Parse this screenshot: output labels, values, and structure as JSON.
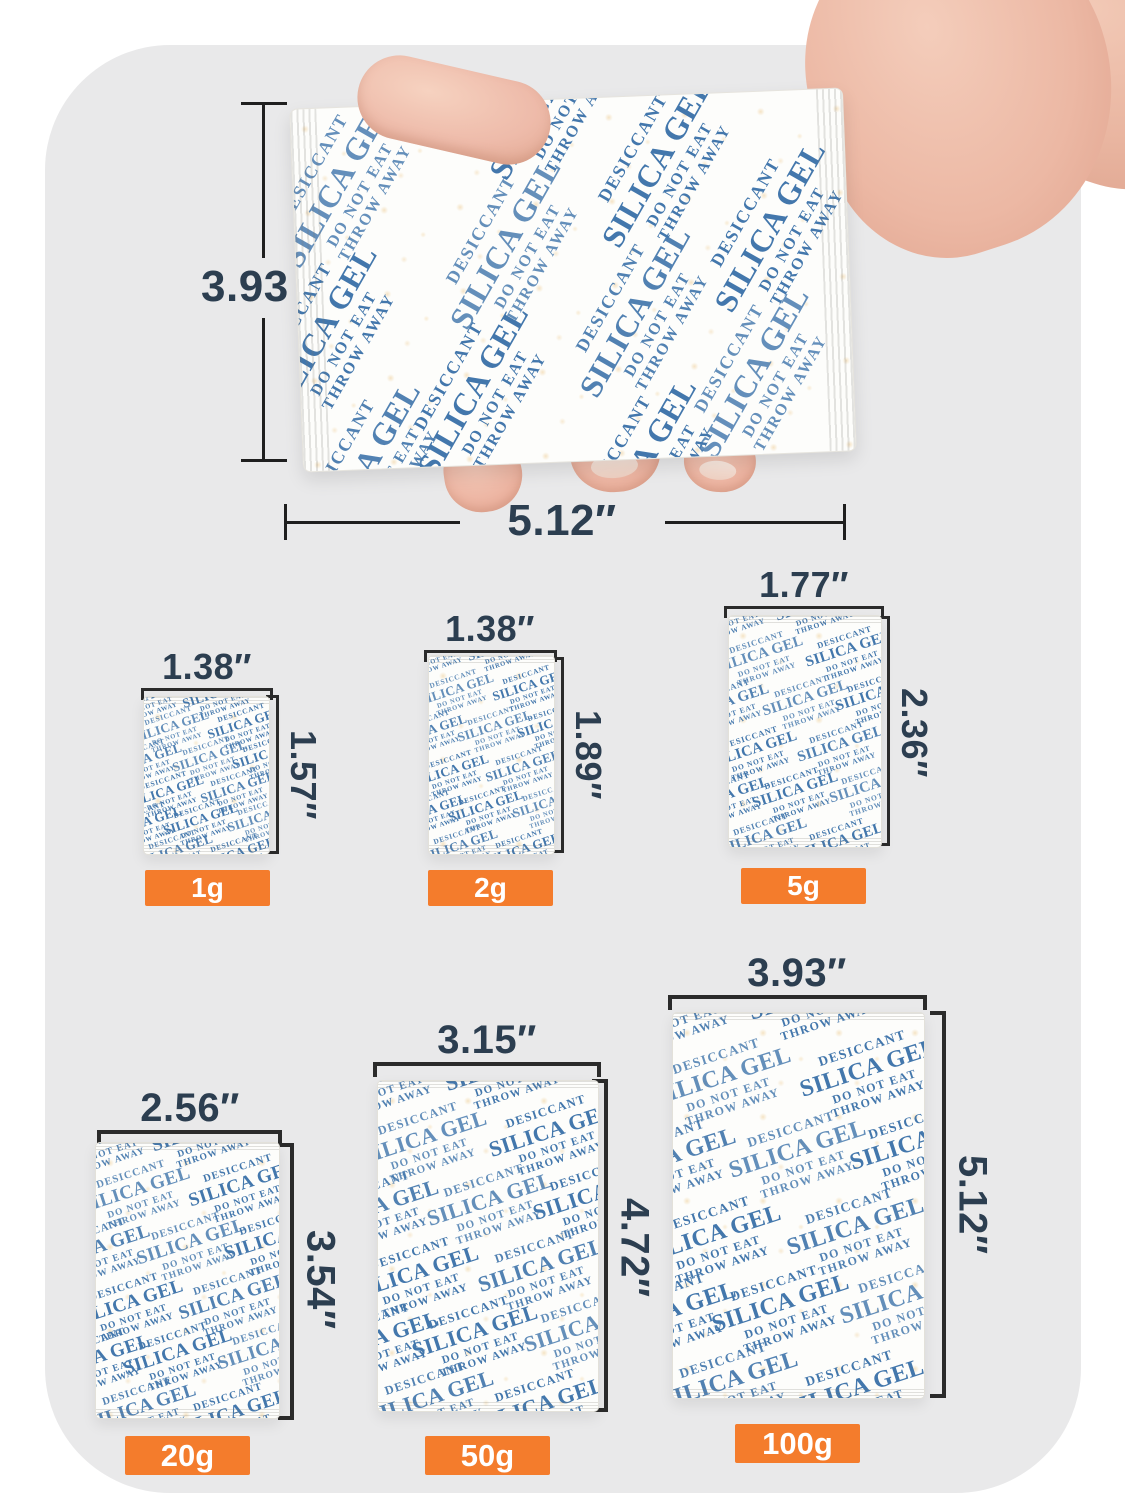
{
  "colors": {
    "card_background": "#e9e9ea",
    "badge_orange": "#f47c2c",
    "packet_print_blue": "#4377ac",
    "dimension_text": "#2c3e50",
    "dimension_line": "#1f1f1f"
  },
  "packet_print": {
    "lines": [
      "DESICCANT",
      "SILICA GEL",
      "DO NOT EAT",
      "THROW AWAY"
    ]
  },
  "hero": {
    "height_label": "3.93 ″",
    "width_label": "5.12″"
  },
  "packets": [
    {
      "id": "1g",
      "width_label": "1.38″",
      "height_label": "1.57″",
      "badge": "1g"
    },
    {
      "id": "2g",
      "width_label": "1.38″",
      "height_label": "1.89″",
      "badge": "2g"
    },
    {
      "id": "5g",
      "width_label": "1.77″",
      "height_label": "2.36″",
      "badge": "5g"
    },
    {
      "id": "20g",
      "width_label": "2.56″",
      "height_label": "3.54″",
      "badge": "20g"
    },
    {
      "id": "50g",
      "width_label": "3.15″",
      "height_label": "4.72″",
      "badge": "50g"
    },
    {
      "id": "100g",
      "width_label": "3.93″",
      "height_label": "5.12″",
      "badge": "100g"
    }
  ]
}
